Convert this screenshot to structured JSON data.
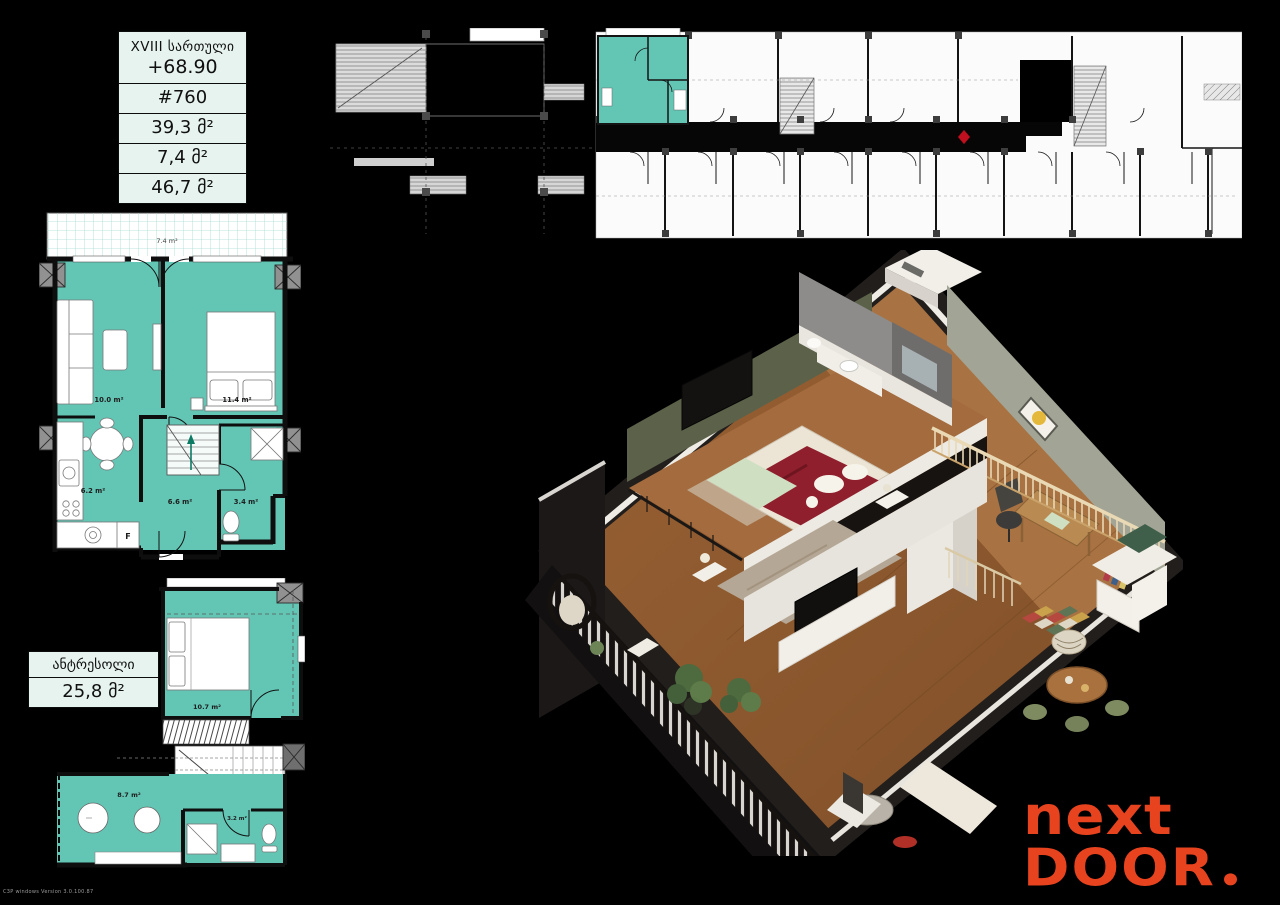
{
  "colors": {
    "background": "#000000",
    "highlight_teal": "#63c6b5",
    "card_mint": "#e6f3ef",
    "logo_orange": "#e8431f",
    "marker_red": "#c01020"
  },
  "info_card": {
    "floor_label": "XVIII სართული",
    "elevation": "+68.90",
    "unit_number": "#760",
    "area_inner": "39,3 მ²",
    "area_balcony": "7,4 მ²",
    "area_total": "46,7 მ²"
  },
  "mezzanine_card": {
    "label": "ანტრესოლი",
    "area": "25,8 მ²"
  },
  "main_plan_labels": {
    "terrace": "7.4 m²",
    "living": "10.0 m²",
    "bedroom": "11.4 m²",
    "kitchen": "6.2 m²",
    "hall": "6.6 m²",
    "bathroom": "3.4 m²",
    "fridge": "F"
  },
  "mezzanine_plan_labels": {
    "bedroom": "10.7 m²",
    "lounge": "8.7 m²",
    "bathroom": "3.2 m²"
  },
  "logo": {
    "word1": "next",
    "word2": "DOOR"
  },
  "watermark": "C3P windows Version 3.0.100.87"
}
